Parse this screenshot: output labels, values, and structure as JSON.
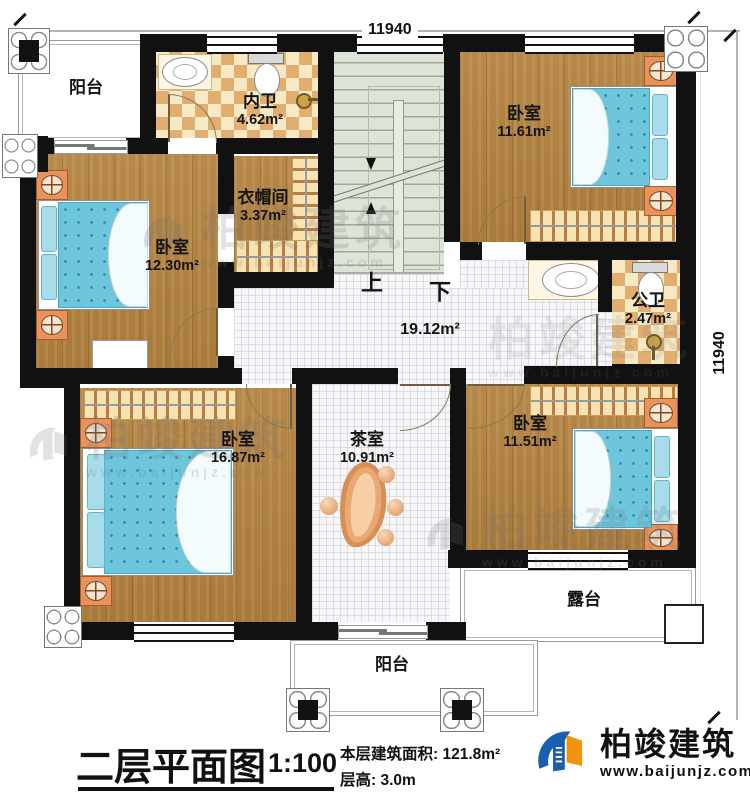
{
  "type": "floor-plan",
  "rooms": {
    "balconyTop": {
      "name": "阳台",
      "area": ""
    },
    "bathInner": {
      "name": "内卫",
      "area": "4.62m²"
    },
    "bedroomTopRight": {
      "name": "卧室",
      "area": "11.61m²"
    },
    "cloakroom": {
      "name": "衣帽间",
      "area": "3.37m²"
    },
    "bedroomLeft": {
      "name": "卧室",
      "area": "12.30m²"
    },
    "hall": {
      "name": "",
      "area": "19.12m²"
    },
    "bathPublic": {
      "name": "公卫",
      "area": "2.47m²"
    },
    "bedroomBottomLeft": {
      "name": "卧室",
      "area": "16.87m²"
    },
    "teaRoom": {
      "name": "茶室",
      "area": "10.91m²"
    },
    "bedroomBottomRight": {
      "name": "卧室",
      "area": "11.51m²"
    },
    "terrace": {
      "name": "露台",
      "area": ""
    },
    "balconyBottom": {
      "name": "阳台",
      "area": ""
    }
  },
  "stairs": {
    "up": "上",
    "down": "下"
  },
  "dims": {
    "top": "11940",
    "right": "11940"
  },
  "footer": {
    "title": "二层平面图",
    "scale": "1:100",
    "area_line": "本层建筑面积: 121.8m²",
    "height_line": "层高: 3.0m"
  },
  "brand": {
    "name": "柏竣建筑",
    "url": "www.baijunjz.com"
  },
  "colors": {
    "wall": "#111111",
    "wood": "#b2813e",
    "tile": "#f7f7f9",
    "checker_dark": "#e2ae70",
    "checker_light": "#f7e9c4",
    "stair": "#dde3d6",
    "cream": "#ebe6cd",
    "mattress": "#6ec6dd",
    "accent_orange": "#e8925c",
    "brand_blue": "#1a5faf",
    "brand_orange": "#f2930f"
  }
}
